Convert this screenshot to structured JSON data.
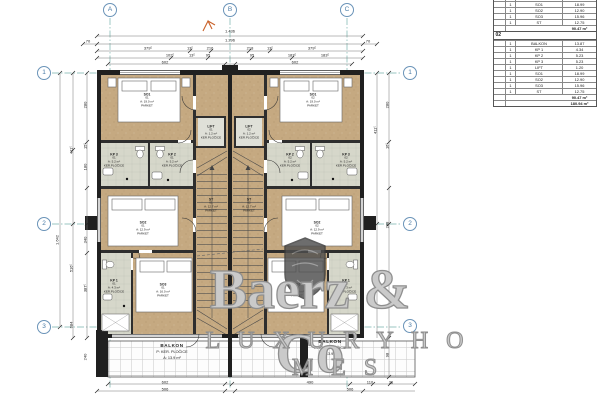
{
  "schedule": {
    "section1": {
      "partial_row": {
        "qty": "1",
        "name": "LIFT",
        "area": "1.20"
      },
      "rows": [
        {
          "qty": "1",
          "name": "SO1",
          "area": "18.99"
        },
        {
          "qty": "1",
          "name": "SO2",
          "area": "12.90"
        },
        {
          "qty": "1",
          "name": "SO3",
          "area": "15.96"
        },
        {
          "qty": "1",
          "name": "ST",
          "area": "12.75"
        }
      ],
      "total": "90.47 m²"
    },
    "section2": {
      "header": "02",
      "rows": [
        {
          "qty": "1",
          "name": "BALKON",
          "area": "13.87"
        },
        {
          "qty": "1",
          "name": "KP 1",
          "area": "4.34"
        },
        {
          "qty": "1",
          "name": "KP 2",
          "area": "5.23"
        },
        {
          "qty": "1",
          "name": "KP 3",
          "area": "5.23"
        },
        {
          "qty": "1",
          "name": "LIFT",
          "area": "1.20"
        },
        {
          "qty": "1",
          "name": "SO1",
          "area": "18.99"
        },
        {
          "qty": "1",
          "name": "SO2",
          "area": "12.90"
        },
        {
          "qty": "1",
          "name": "SO3",
          "area": "15.96"
        },
        {
          "qty": "1",
          "name": "ST",
          "area": "12.75"
        }
      ],
      "total": "90.47 m²",
      "grand_total": "180.94 m²"
    }
  },
  "grid": {
    "cols": [
      "A",
      "B",
      "C"
    ],
    "rows": [
      "1",
      "2",
      "3"
    ]
  },
  "dims": {
    "top": {
      "overall": "1.436",
      "inner": "1.296",
      "end": "70",
      "r3": [
        "379⁵",
        "13⁵",
        "216",
        "218",
        "13⁵",
        "379⁵"
      ],
      "r4": [
        "102⁵",
        "13⁵",
        "95",
        "95",
        "183⁵",
        "183⁵"
      ],
      "r5": [
        "602",
        "602"
      ]
    },
    "left": {
      "outer": "1.642",
      "mid": [
        "411⁵",
        "516⁵",
        "684"
      ],
      "inner": [
        "280",
        "15⁵",
        "180",
        "340",
        "387⁵",
        "240"
      ]
    },
    "right": {
      "mid": "411⁵",
      "inner": [
        "280",
        "16⁵",
        "288",
        "98"
      ]
    },
    "bottom": {
      "r1": [
        "602",
        "490",
        "110",
        "36"
      ],
      "r2": [
        "506",
        "506"
      ]
    }
  },
  "rooms": {
    "u1": {
      "so1": {
        "code": "SO1",
        "num": "01",
        "area": "A: 19.0 m²",
        "floor": "PARKET"
      },
      "so2": {
        "code": "SO2",
        "num": "01",
        "area": "A: 12.9 m²",
        "floor": "PARKET"
      },
      "so3": {
        "code": "SO3",
        "num": "01",
        "area": "A: 16.0 m²",
        "floor": "PARKET"
      },
      "kp1": {
        "code": "KP 1",
        "num": "01",
        "area": "A: 4.3 m²",
        "floor": "KER.PLOČICE"
      },
      "kp2": {
        "code": "KP 2",
        "num": "01",
        "area": "A: 5.2 m²",
        "floor": "KER.PLOČICE"
      },
      "kp3": {
        "code": "KP 3",
        "num": "01",
        "area": "A: 5.2 m²",
        "floor": "KER.PLOČICE"
      },
      "lift": {
        "code": "LIFT",
        "num": "01",
        "area": "A: 1.2 m²",
        "floor": "KER.PLOČICE"
      },
      "st": {
        "code": "ST",
        "num": "01",
        "area": "A: 12.7 m²",
        "floor": "PARKET"
      },
      "balkon": {
        "code": "BALKON",
        "floor": "P: KER. PLOČICE",
        "area": "A: 13.9 m²"
      }
    },
    "u2": {
      "so1": {
        "code": "SO1",
        "num": "02",
        "area": "A: 19.0 m²",
        "floor": "PARKET"
      },
      "so2": {
        "code": "SO2",
        "num": "02",
        "area": "A: 12.9 m²",
        "floor": "PARKET"
      },
      "so3": {
        "code": "SO3",
        "num": "02",
        "area": "A: 16.0 m²",
        "floor": "PARKET"
      },
      "kp1": {
        "code": "KP 1",
        "num": "02",
        "area": "A: 4.3 m²",
        "floor": "KER.PLOČICE"
      },
      "kp2": {
        "code": "KP 2",
        "num": "02",
        "area": "A: 5.2 m²",
        "floor": "KER.PLOČICE"
      },
      "kp3": {
        "code": "KP 3",
        "num": "02",
        "area": "A: 5.2 m²",
        "floor": "KER.PLOČICE"
      },
      "lift": {
        "code": "LIFT",
        "num": "02",
        "area": "A: 1.2 m²",
        "floor": "KER.PLOČICE"
      },
      "st": {
        "code": "ST",
        "num": "02",
        "area": "A: 12.7 m²",
        "floor": "PARKET"
      },
      "balkon": {
        "code": "BALKON",
        "floor": "P: KER. PLOČICE",
        "area": "A: 13.9 m²"
      }
    }
  },
  "watermark": {
    "name": "Baerz & Co",
    "tagline": "L U X U R Y   H O M E S"
  }
}
